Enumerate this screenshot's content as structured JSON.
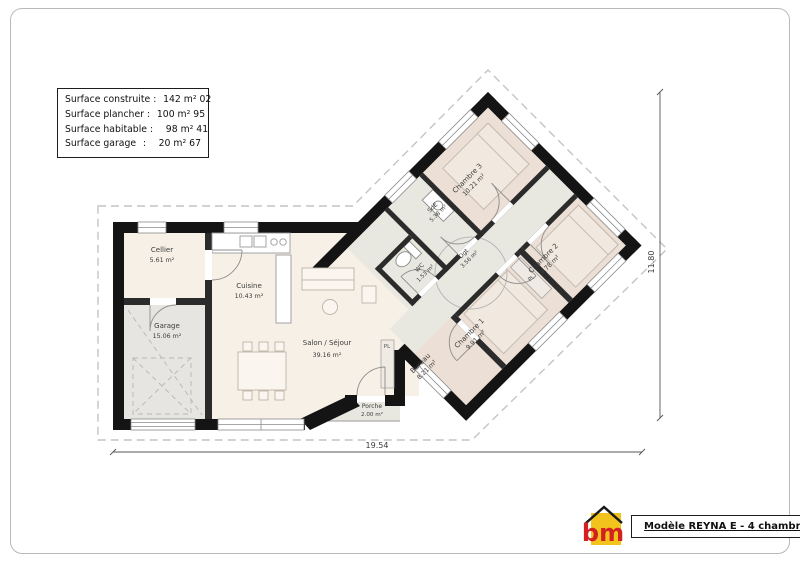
{
  "info_box": {
    "rows": [
      {
        "label": "Surface construite",
        "sep": ":",
        "value": "142 m² 02"
      },
      {
        "label": "Surface plancher",
        "sep": ":",
        "value": "100 m² 95"
      },
      {
        "label": "Surface habitable",
        "sep": ":",
        "value": "98 m² 41"
      },
      {
        "label": "Surface garage",
        "sep": ":",
        "value": "20 m² 67"
      }
    ]
  },
  "rooms": {
    "cellier": {
      "name": "Cellier",
      "area": "5.61 m²"
    },
    "garage": {
      "name": "Garage",
      "area": "15.06 m²"
    },
    "cuisine": {
      "name": "Cuisine",
      "area": "10.43 m²"
    },
    "salon": {
      "name": "Salon / Séjour",
      "area": "39.16 m²"
    },
    "porche": {
      "name": "Porche",
      "area": "2.00 m²"
    },
    "bureau": {
      "name": "Bureau",
      "area": "8.21 m²"
    },
    "chambre1": {
      "name": "Chambre 1",
      "area": "9.91 m²"
    },
    "chambre2": {
      "name": "Chambre 2",
      "area": "9.78 m²"
    },
    "chambre3": {
      "name": "Chambre 3",
      "area": "10.21 m²"
    },
    "sde": {
      "name": "SdE",
      "area": "5.38 m²"
    },
    "wc": {
      "name": "WC",
      "area": "1.53 m²"
    },
    "dgt": {
      "name": "Dgt",
      "area": "3.56 m²"
    },
    "placard": "PL"
  },
  "dimensions": {
    "width": "19.54",
    "height": "11.80"
  },
  "title_block": {
    "model": "Modèle REYNA E - 4 chambres",
    "logo": "bm"
  },
  "colors": {
    "wall": "#141414",
    "interior_wall": "#2b2b2b",
    "floor_living": "#f7f0e7",
    "floor_bedroom": "#ecdfd5",
    "floor_service": "#e8e8e0",
    "floor_garage": "#e6e5e2",
    "logo_yellow": "#f2c21d",
    "logo_red": "#d42020"
  }
}
